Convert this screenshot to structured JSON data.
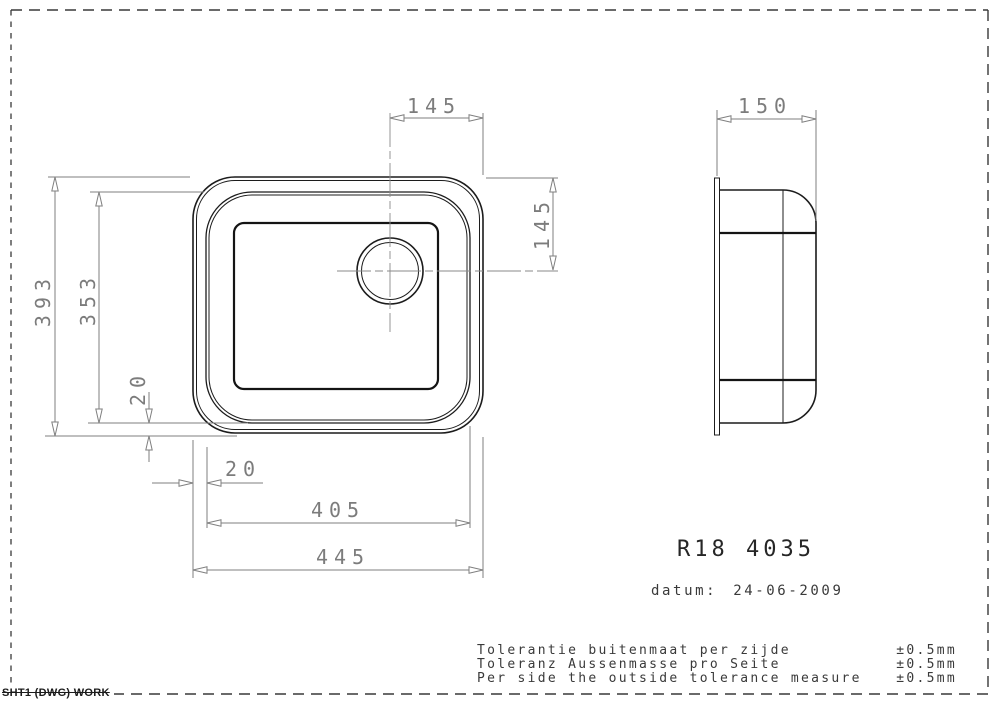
{
  "sheet": {
    "stamp": "SHT1 (DWG) WORK"
  },
  "title_block": {
    "model": "R18 4035",
    "date_label": "datum:",
    "date": "24-06-2009"
  },
  "tolerance_notes": [
    {
      "text": "Tolerantie buitenmaat per zijde",
      "value": "±0.5mm"
    },
    {
      "text": "Toleranz Aussenmasse pro Seite",
      "value": "±0.5mm"
    },
    {
      "text": "Per side the outside tolerance measure",
      "value": "±0.5mm"
    }
  ],
  "dimensions": {
    "drain_offset_from_right_edge": "145",
    "side_view_depth": "150",
    "drain_offset_from_top_edge": "145",
    "outer_height": "393",
    "bowl_opening_height": "353",
    "rim_width_bottom": "20",
    "rim_width_left": "20",
    "bowl_opening_width": "405",
    "outer_width": "445"
  },
  "colors": {
    "geometry_line": "#1c1c1c",
    "dimension_line": "#7f7f7f",
    "background": "#ffffff"
  }
}
